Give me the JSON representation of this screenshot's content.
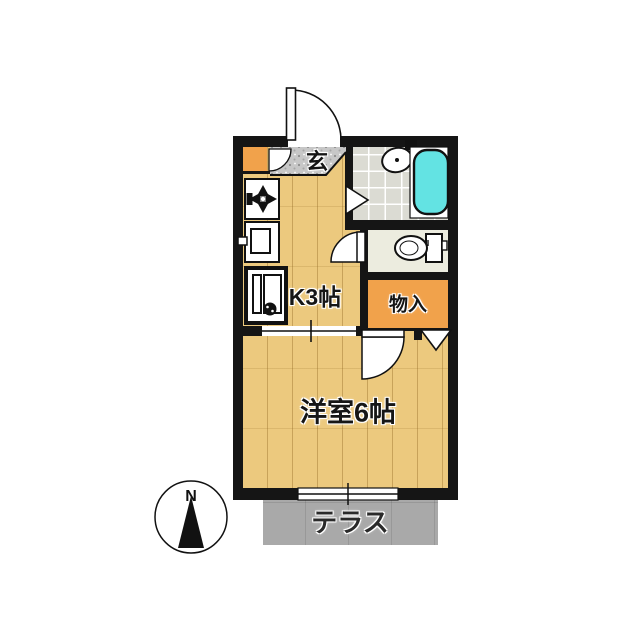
{
  "figure_type": "japanese-apartment-floor-plan",
  "labels": {
    "entrance": "玄",
    "kitchen": "K3帖",
    "storage": "物入",
    "western_room": "洋室6帖",
    "terrace": "テラス",
    "compass_north": "N"
  },
  "colors": {
    "background": "#FFFFFF",
    "wall": "#151515",
    "wood": "#ECC97E",
    "storage_orange": "#F1A24B",
    "bathtub_cyan": "#63E3E3",
    "bath_tile": "#DBDBD3",
    "toilet_floor": "#ECECDF",
    "genkan_gray": "#C7C7C7",
    "terrace_gray": "#A9A9A9",
    "label_text": "#161616"
  },
  "icons": [
    "entrance-door-swing-icon",
    "shoe-cabinet-door-icon",
    "gas-stove-icon",
    "kitchen-sink-icon",
    "appliance-space-icon",
    "bath-folding-door-icon",
    "washbasin-icon",
    "bathtub-icon",
    "toilet-icon",
    "toilet-door-swing-icon",
    "storage-hinged-door-icon",
    "storage-folding-door-icon",
    "sliding-opening-icon",
    "sliding-window-icon",
    "north-compass-icon"
  ]
}
